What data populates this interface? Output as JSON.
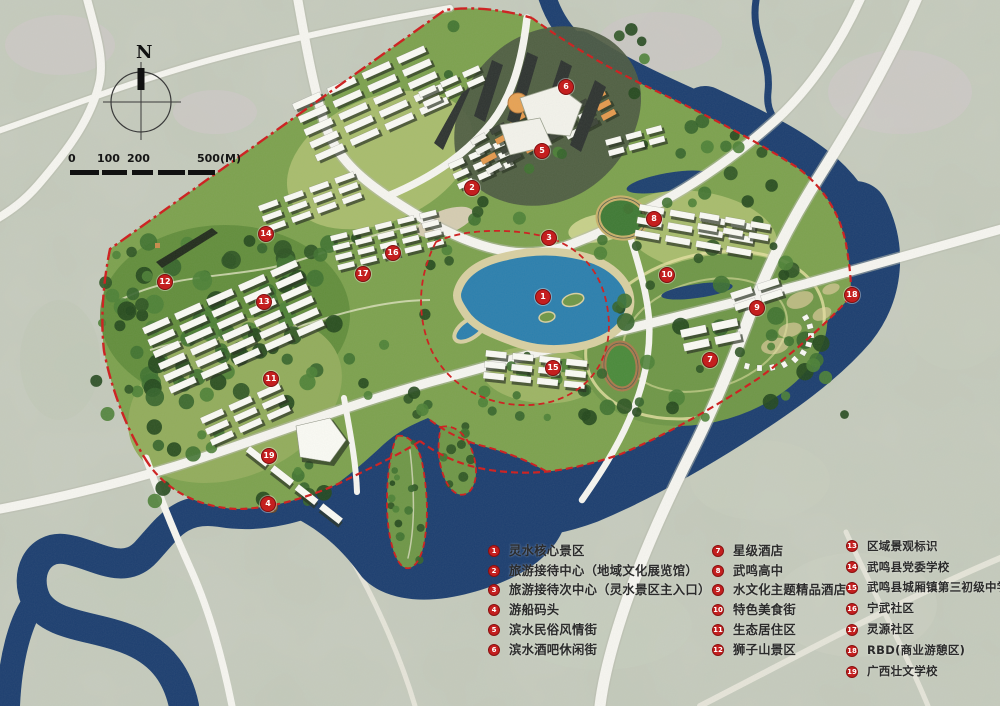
{
  "compass": {
    "label": "N"
  },
  "scale_bar": {
    "labels": [
      "0",
      "100",
      "200",
      "500",
      "(M)"
    ]
  },
  "legend": {
    "columns": [
      {
        "items": [
          {
            "num": "1",
            "label": "灵水核心景区"
          },
          {
            "num": "2",
            "label": "旅游接待中心（地域文化展览馆）"
          },
          {
            "num": "3",
            "label": "旅游接待次中心（灵水景区主入口）"
          },
          {
            "num": "4",
            "label": "游船码头"
          },
          {
            "num": "5",
            "label": "滨水民俗风情街"
          },
          {
            "num": "6",
            "label": "滨水酒吧休闲街"
          }
        ]
      },
      {
        "items": [
          {
            "num": "7",
            "label": "星级酒店"
          },
          {
            "num": "8",
            "label": "武鸣高中"
          },
          {
            "num": "9",
            "label": "水文化主题精品酒店"
          },
          {
            "num": "10",
            "label": "特色美食街"
          },
          {
            "num": "11",
            "label": "生态居住区"
          },
          {
            "num": "12",
            "label": "狮子山景区"
          }
        ]
      },
      {
        "items": [
          {
            "num": "13",
            "label": "区域景观标识"
          },
          {
            "num": "14",
            "label": "武鸣县党委学校"
          },
          {
            "num": "15",
            "label": "武鸣县城厢镇第三初级中学"
          },
          {
            "num": "16",
            "label": "宁武社区"
          },
          {
            "num": "17",
            "label": "灵源社区"
          },
          {
            "num": "18",
            "label": "RBD(商业游憩区)"
          },
          {
            "num": "19",
            "label": "广西壮文学校"
          }
        ]
      }
    ]
  },
  "markers": [
    {
      "num": "1",
      "x": 542,
      "y": 296
    },
    {
      "num": "2",
      "x": 471,
      "y": 187
    },
    {
      "num": "3",
      "x": 548,
      "y": 237
    },
    {
      "num": "4",
      "x": 267,
      "y": 503
    },
    {
      "num": "5",
      "x": 541,
      "y": 150
    },
    {
      "num": "6",
      "x": 565,
      "y": 86
    },
    {
      "num": "7",
      "x": 709,
      "y": 359
    },
    {
      "num": "8",
      "x": 653,
      "y": 218
    },
    {
      "num": "9",
      "x": 756,
      "y": 307
    },
    {
      "num": "10",
      "x": 666,
      "y": 274
    },
    {
      "num": "11",
      "x": 270,
      "y": 378
    },
    {
      "num": "12",
      "x": 164,
      "y": 281
    },
    {
      "num": "13",
      "x": 263,
      "y": 301
    },
    {
      "num": "14",
      "x": 265,
      "y": 233
    },
    {
      "num": "15",
      "x": 552,
      "y": 367
    },
    {
      "num": "16",
      "x": 392,
      "y": 252
    },
    {
      "num": "17",
      "x": 362,
      "y": 273
    },
    {
      "num": "18",
      "x": 851,
      "y": 294
    },
    {
      "num": "19",
      "x": 268,
      "y": 455
    }
  ],
  "colors": {
    "boundary_red": "#cf1c1c",
    "marker_red": "#c41f1f",
    "river_blue": "#1c3e70",
    "lake_blue": "#2b7fae",
    "site_green": "#7da24e",
    "road_white": "#f7f6f1",
    "building_orange": "#e59a4e"
  }
}
